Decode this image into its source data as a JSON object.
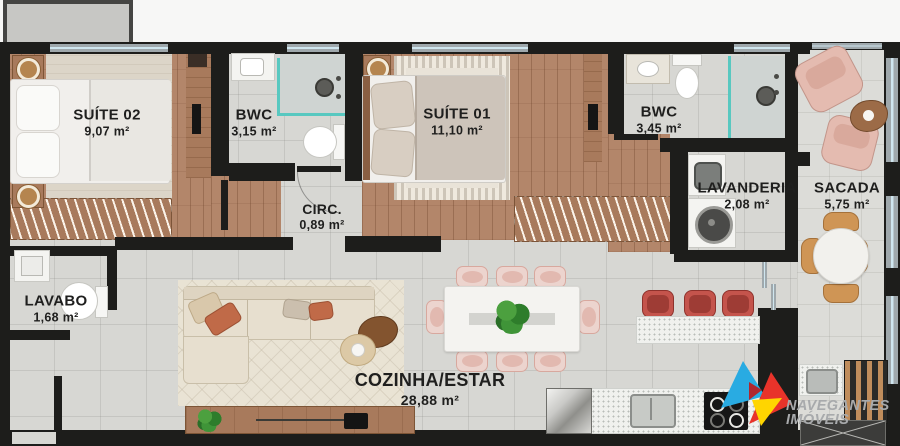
{
  "plan": {
    "title": "Apartment floor plan",
    "rooms": {
      "suite02": {
        "name": "SUÍTE 02",
        "area": "9,07 m²"
      },
      "bwc1": {
        "name": "BWC",
        "area": "3,15 m²"
      },
      "suite01": {
        "name": "SUÍTE 01",
        "area": "11,10 m²"
      },
      "bwc2": {
        "name": "BWC",
        "area": "3,45 m²"
      },
      "lavanderia": {
        "name": "LAVANDERIA",
        "area": "2,08 m²"
      },
      "sacada": {
        "name": "SACADA",
        "area": "5,75 m²"
      },
      "circ": {
        "name": "CIRC.",
        "area": "0,89 m²"
      },
      "lavabo": {
        "name": "LAVABO",
        "area": "1,68 m²"
      },
      "cozinha_estar": {
        "name": "COZINHA/ESTAR",
        "area": "28,88 m²"
      }
    },
    "brand": {
      "line1": "NAVEGANTES",
      "line2": "IMÓVEIS",
      "logo_colors": {
        "blue": "#29abe2",
        "red": "#e8332a",
        "dark_red": "#b0272f",
        "yellow": "#ffd500",
        "text": "#a8aaac"
      }
    }
  }
}
